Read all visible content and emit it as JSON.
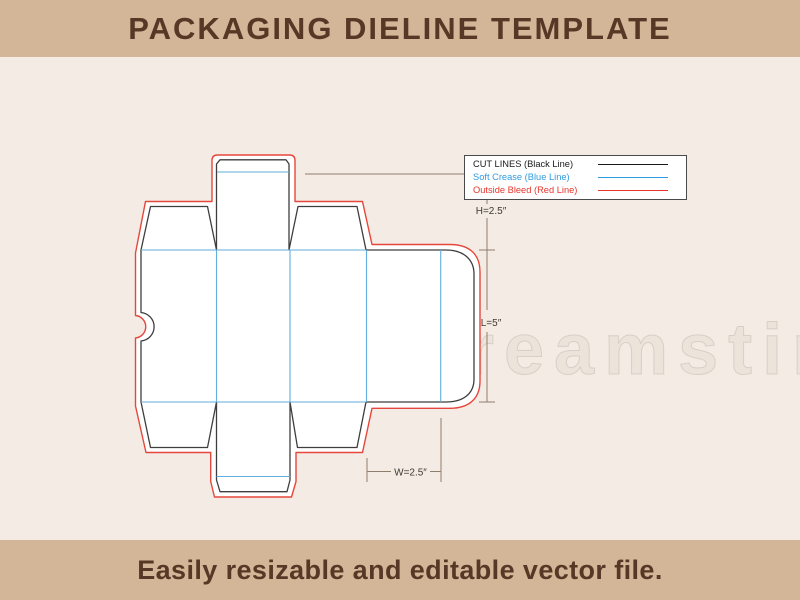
{
  "header": {
    "title": "PACKAGING DIELINE TEMPLATE"
  },
  "footer": {
    "text": "Easily resizable and editable vector file."
  },
  "legend": {
    "items": [
      {
        "label": "CUT LINES (Black Line)",
        "color": "#1a1a1a"
      },
      {
        "label": "Soft Crease (Blue Line)",
        "color": "#2f9ce0"
      },
      {
        "label": "Outside Bleed (Red Line)",
        "color": "#e6352b"
      }
    ]
  },
  "dimensions": {
    "height_label": "H=2.5″",
    "length_label": "L=5″",
    "width_label": "W=2.5″"
  },
  "watermark": {
    "text": "dreamstime"
  },
  "colors": {
    "banner_bg": "#d3b697",
    "banner_text": "#573826",
    "canvas_bg": "#f4ebe4",
    "panel_fill": "#ffffff",
    "cut_line": "#3e3e3e",
    "crease_line": "#62aede",
    "bleed_line": "#e6473c",
    "dimension_line": "#8f7d6e",
    "dimension_text": "#3f3a34",
    "legend_border": "#4a4a4a",
    "legend_bg": "#ffffff"
  }
}
